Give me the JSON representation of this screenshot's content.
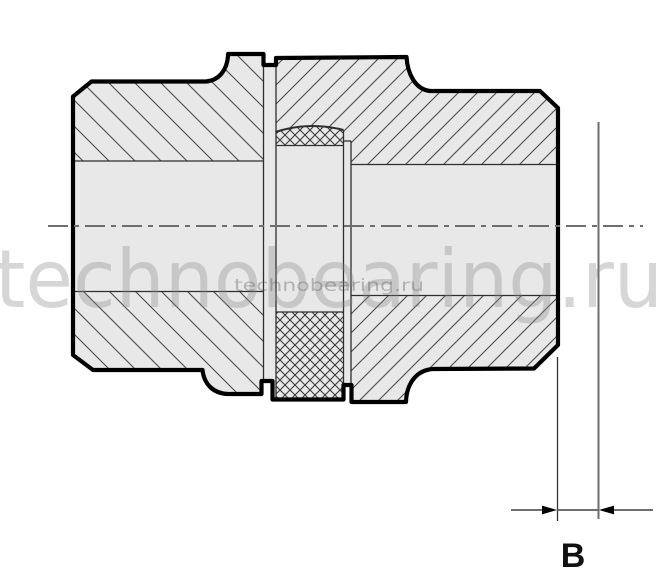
{
  "drawing": {
    "type_note": "sectional view of jaw coupling",
    "dimension_label": "B",
    "watermark_large": "technobearing.ru",
    "watermark_small": "technobearing.ru"
  },
  "colors": {
    "bg": "#ffffff",
    "part-fill": "#e8e8e8",
    "outline": "#000000",
    "thin": "#2e2e2e",
    "hatch": "#4a4a4a",
    "dim": "#6e6e6e",
    "label": "#111111",
    "watermark": "#878787"
  }
}
